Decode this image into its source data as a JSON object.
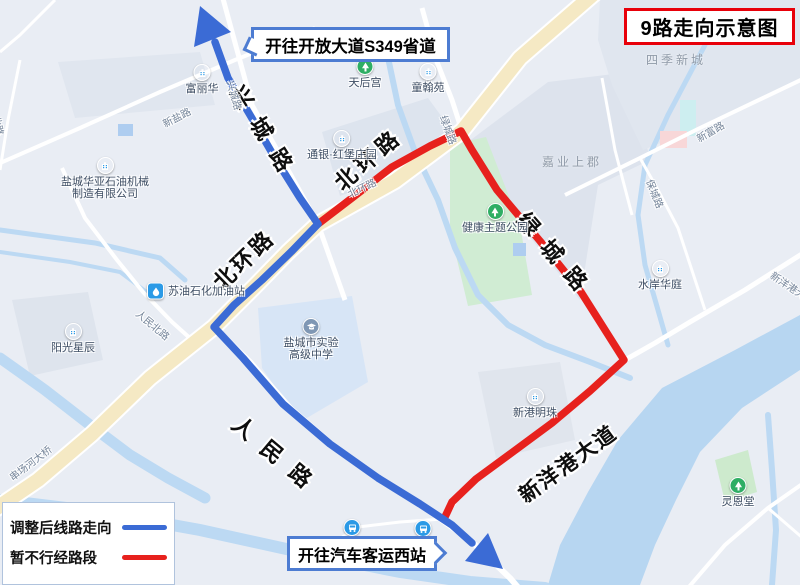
{
  "title": {
    "text": "9路走向示意图"
  },
  "callouts": {
    "north": {
      "text": "开往开放大道S349省道"
    },
    "south": {
      "text": "开往汽车客运西站"
    }
  },
  "legend": {
    "items": [
      {
        "label": "调整后线路走向",
        "color": "#3b6bd5"
      },
      {
        "label": "暂不行经路段",
        "color": "#e7211d"
      }
    ]
  },
  "map": {
    "colors": {
      "background": "#e9edf4",
      "block": "#dde4ee",
      "school_block": "#d7e5f6",
      "water": "#bcd9f3",
      "river": "#b7d6f1",
      "park": "#d0ecd3",
      "road_minor": "#ffffff",
      "road_main_fill": "#f5e9c4",
      "road_main_casing": "#ffffff",
      "route_blue": "#3b6bd5",
      "route_red": "#e7211d"
    },
    "blocks": [
      {
        "name": "block",
        "points": "58,62 200,52 215,105 75,118",
        "fill": "#e0e6ef"
      },
      {
        "name": "block",
        "points": "322,132 428,98 450,128 390,178 340,196",
        "fill": "#dde4ee"
      },
      {
        "name": "block-jiaye",
        "points": "468,142 548,82 630,72 650,160 598,185 580,300 518,222",
        "fill": "#dde3ed"
      },
      {
        "name": "block-siji",
        "points": "600,0 800,0 800,78 700,127 643,150 612,85 598,40",
        "fill": "#e0e6ef"
      },
      {
        "name": "block-school",
        "points": "258,308 352,296 368,382 300,422 262,368",
        "fill": "#d7e5f6"
      },
      {
        "name": "block",
        "points": "12,300 88,292 103,360 30,376",
        "fill": "#dee4ed"
      },
      {
        "name": "block-xingang",
        "points": "478,372 560,362 575,440 496,458",
        "fill": "#e0e5ed"
      },
      {
        "name": "park-lingentang",
        "points": "715,460 748,450 757,492 725,502",
        "fill": "#cdeacd"
      },
      {
        "name": "park-health-theme",
        "points": "450,145 486,137 520,225 532,295 468,306 450,230",
        "fill": "#d0ecd3"
      }
    ],
    "water_polygons": [
      {
        "name": "river-xinyanggang",
        "points": "800,315 735,350 662,388 618,440 588,492 560,545 548,585 640,585 655,545 676,500 700,452 742,408 800,370",
        "fill": "#b7d6f1"
      }
    ],
    "water_lines": [
      {
        "name": "canal",
        "d": "M0,230 L95,243 L160,258 L185,280",
        "w": 5
      },
      {
        "name": "canal",
        "d": "M0,252 L70,262 L120,272 L152,296",
        "w": 4
      },
      {
        "name": "river-chuanchang",
        "d": "M0,358 L45,390 L90,425 L130,455 L168,478 L205,498",
        "w": 11
      },
      {
        "name": "river-south",
        "d": "M0,500 L100,512 L200,530 L300,552 L400,572 L470,582 L545,588",
        "w": 12
      },
      {
        "name": "canal-center",
        "d": "M386,48 L398,105 L415,152 L438,200 L455,248 L478,295 L508,325 L545,345 L590,362 L630,378",
        "w": 6
      },
      {
        "name": "canal-east",
        "d": "M705,45 L668,115 L645,165 L638,215 L645,265 L658,310 L668,345",
        "w": 5
      },
      {
        "name": "canal-east-2",
        "d": "M768,415 L772,470 L776,530 L772,585",
        "w": 6
      }
    ],
    "decor_rects": [
      {
        "x": 118,
        "y": 124,
        "w": 15,
        "h": 12,
        "fill": "#aecdf0"
      },
      {
        "x": 513,
        "y": 243,
        "w": 13,
        "h": 13,
        "fill": "#aecdf0"
      },
      {
        "x": 680,
        "y": 100,
        "w": 16,
        "h": 36,
        "fill": "#cdeef0"
      },
      {
        "x": 660,
        "y": 131,
        "w": 27,
        "h": 17,
        "fill": "#f8d7d8"
      }
    ],
    "roads_minor": [
      {
        "name": "xingcheng-rd",
        "d": "M222,-5 L252,105 L318,224 L345,300",
        "w": 5
      },
      {
        "name": "renmin-rd",
        "d": "M214,327 L250,362 L290,408 L335,447 L380,480 L425,508 L470,540 L510,578 L522,592",
        "w": 6
      },
      {
        "name": "renminbei-rd",
        "d": "M62,168 L85,218 L117,260 L143,292 L172,322 L192,340",
        "w": 4
      },
      {
        "name": "lvcheng-rd",
        "d": "M422,8 L437,62 L452,100 L462,131 L497,190 L540,241 L582,293 L625,360",
        "w": 5
      },
      {
        "name": "xinyanggang-ave",
        "d": "M805,252 L745,290 L690,322 L655,343 L625,360 L560,418 L505,458 L460,492 L444,520",
        "w": 5
      },
      {
        "name": "station-rd",
        "d": "M330,545 L358,527 L400,522 L443,519",
        "w": 3
      },
      {
        "name": "xinyan-rd",
        "d": "M0,163 L80,128 L160,92 L235,60 L315,28",
        "w": 4
      },
      {
        "name": "minor",
        "d": "M55,0 L20,35 L0,52",
        "w": 3
      },
      {
        "name": "minor",
        "d": "M20,60 L8,120 L0,170",
        "w": 3
      },
      {
        "name": "xinfu-rd",
        "d": "M805,78 L700,128 L640,158 L565,195",
        "w": 4
      },
      {
        "name": "baocheng-rd",
        "d": "M640,158 L658,190 L678,228 L705,310",
        "w": 3
      },
      {
        "name": "minor",
        "d": "M602,78 L615,150 L632,215",
        "w": 3
      },
      {
        "name": "minor",
        "d": "M688,588 L725,545 L768,508 L805,482",
        "w": 4
      },
      {
        "name": "minor",
        "d": "M768,508 L805,540",
        "w": 3
      }
    ],
    "road_main": {
      "name": "beihuan-rd-main",
      "d": "M596,-8 L520,58 L462,131 L395,181 L318,224 L288,252 L255,286 L214,327 L150,378 L92,434 L38,480 L-6,510",
      "casing_w": 18,
      "fill_w": 14
    },
    "routes": {
      "blue": {
        "d": "M215,42 L228,78 L250,115 L275,158 L300,198 L318,224 L292,251 L262,280 L234,305 L214,327 L243,358 L283,404 L330,444 L378,478 L420,504 L452,525 L472,543",
        "w": 7.5
      },
      "red": {
        "d": "M318,224 L352,198 L392,167 L430,146 L461,131 L472,150 L497,190 L540,241 L581,292 L624,360 L590,391 L552,423 L510,454 L476,479 L452,502 L444,519",
        "w": 7.5
      },
      "arrowheads": [
        {
          "name": "arrow-north",
          "points": "200,6 231,32 194,47"
        },
        {
          "name": "arrow-south",
          "points": "503,569 488,533 465,561"
        }
      ]
    },
    "street_labels_large": [
      {
        "text": "兴城路",
        "x": 237,
        "y": 71,
        "rot": 58,
        "ls": 15,
        "size": 22
      },
      {
        "text": "北环路",
        "x": 337,
        "y": 169,
        "rot": -41,
        "ls": 5,
        "size": 22
      },
      {
        "text": "北环路",
        "x": 216,
        "y": 269,
        "rot": -44,
        "ls": 3,
        "size": 22
      },
      {
        "text": "绿城路",
        "x": 522,
        "y": 199,
        "rot": 49,
        "ls": 14,
        "size": 22
      },
      {
        "text": "人民路",
        "x": 236,
        "y": 404,
        "rot": 40,
        "ls": 15,
        "size": 22
      },
      {
        "text": "新洋港大道",
        "x": 521,
        "y": 482,
        "rot": -36,
        "ls": 2,
        "size": 21
      }
    ],
    "street_labels_small": [
      {
        "text": "新盐路",
        "x": 163,
        "y": 116,
        "rot": -27
      },
      {
        "text": "北路",
        "x": -3,
        "y": 108,
        "rot": 78
      },
      {
        "text": "兴城路",
        "x": 231,
        "y": 73,
        "rot": 74
      },
      {
        "text": "北环路",
        "x": 348,
        "y": 186,
        "rot": -25
      },
      {
        "text": "绿城路",
        "x": 444,
        "y": 108,
        "rot": 70
      },
      {
        "text": "人民北路",
        "x": 138,
        "y": 304,
        "rot": 40
      },
      {
        "text": "串场河大桥",
        "x": 10,
        "y": 470,
        "rot": -37
      },
      {
        "text": "新富路",
        "x": 697,
        "y": 131,
        "rot": -30
      },
      {
        "text": "保城路",
        "x": 650,
        "y": 172,
        "rot": 68
      },
      {
        "text": "新洋港大道",
        "x": 772,
        "y": 266,
        "rot": 34
      }
    ],
    "area_labels": [
      {
        "text": "四季新城",
        "x": 646,
        "y": 51
      },
      {
        "text": "嘉业上郡",
        "x": 542,
        "y": 153
      }
    ],
    "pois": [
      {
        "lines": [
          "富丽华"
        ],
        "x": 202,
        "y": 64,
        "type": "building",
        "icon": "building-icon"
      },
      {
        "lines": [
          "盐城华亚石油机械",
          "制造有限公司"
        ],
        "x": 105,
        "y": 157,
        "type": "building",
        "icon": "building-icon"
      },
      {
        "lines": [
          "通银·红堡庄园"
        ],
        "x": 342,
        "y": 130,
        "type": "building",
        "icon": "building-icon"
      },
      {
        "lines": [
          "天后宫"
        ],
        "x": 365,
        "y": 58,
        "type": "green",
        "icon": "tree-icon"
      },
      {
        "lines": [
          "童翰苑"
        ],
        "x": 428,
        "y": 63,
        "type": "building",
        "icon": "building-icon"
      },
      {
        "lines": [
          "健康主题公园"
        ],
        "x": 495,
        "y": 203,
        "type": "green",
        "icon": "tree-icon"
      },
      {
        "lines": [
          "水岸华庭"
        ],
        "x": 660,
        "y": 260,
        "type": "building",
        "icon": "building-icon"
      },
      {
        "lines": [
          "新港明珠"
        ],
        "x": 535,
        "y": 388,
        "type": "building",
        "icon": "building-icon"
      },
      {
        "lines": [
          "阳光星辰"
        ],
        "x": 73,
        "y": 323,
        "type": "building",
        "icon": "building-icon"
      },
      {
        "lines": [
          "盐城市实验",
          "高级中学"
        ],
        "x": 311,
        "y": 318,
        "type": "school",
        "icon": "school-icon"
      },
      {
        "lines": [
          "灵恩堂"
        ],
        "x": 738,
        "y": 477,
        "type": "green",
        "icon": "tree-icon"
      },
      {
        "lines": [],
        "x": 352,
        "y": 519,
        "type": "bus",
        "icon": "bus-icon"
      },
      {
        "lines": [],
        "x": 423,
        "y": 520,
        "type": "bus",
        "icon": "bus-icon"
      },
      {
        "lines": [
          "苏油石化加油站"
        ],
        "x": 155,
        "y": 291,
        "type": "gas",
        "icon": "gas-pump-icon"
      }
    ]
  }
}
